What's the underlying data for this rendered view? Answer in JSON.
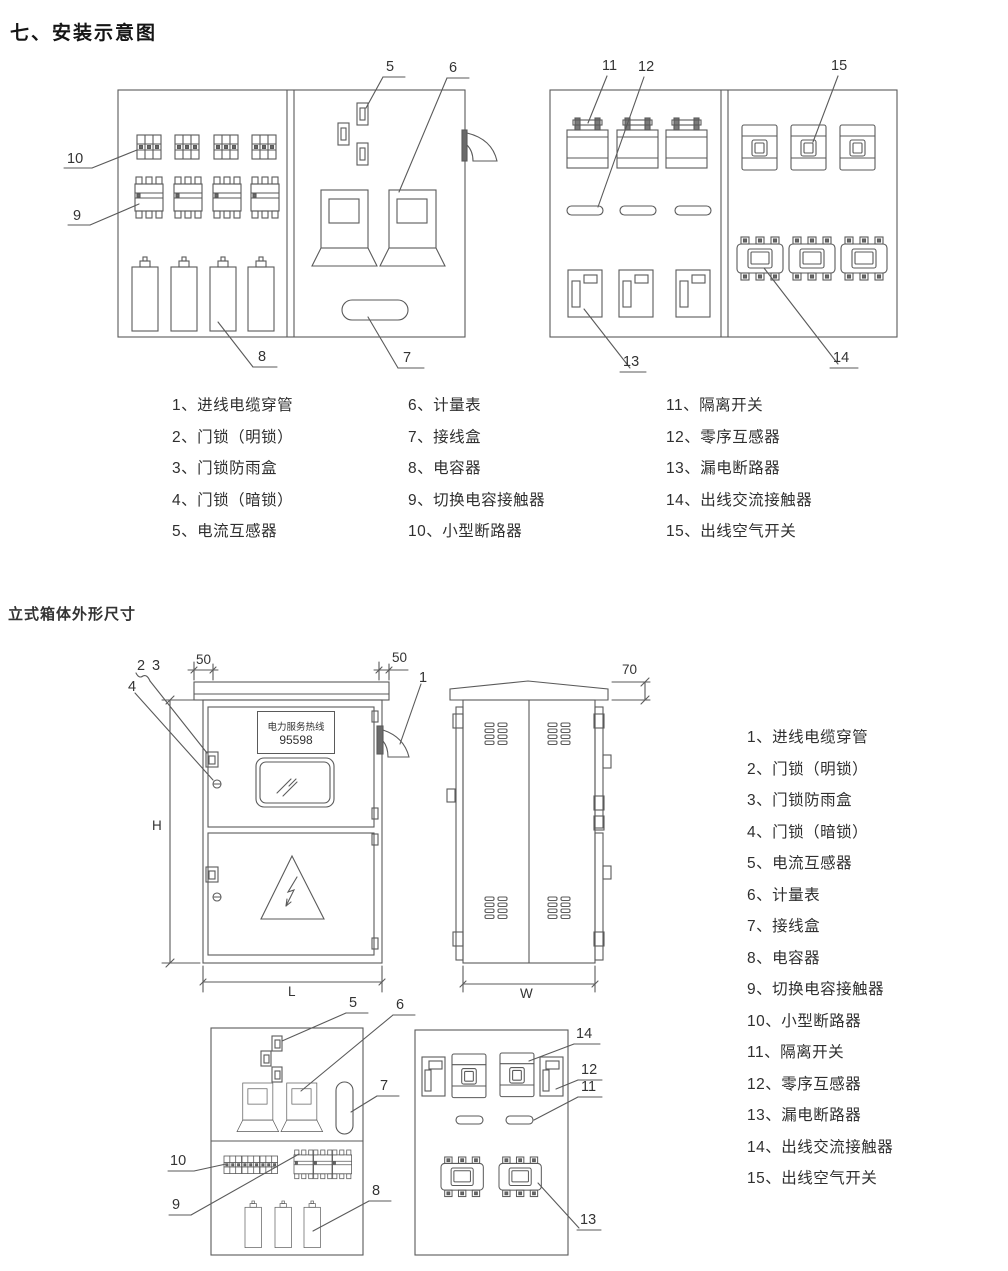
{
  "page": {
    "title": "七、安装示意图",
    "section2_title": "立式箱体外形尺寸"
  },
  "legend": {
    "items": [
      "1、进线电缆穿管",
      "2、门锁（明锁）",
      "3、门锁防雨盒",
      "4、门锁（暗锁）",
      "5、电流互感器",
      "6、计量表",
      "7、接线盒",
      "8、电容器",
      "9、切换电容接触器",
      "10、小型断路器",
      "11、隔离开关",
      "12、零序互感器",
      "13、漏电断路器",
      "14、出线交流接触器",
      "15、出线空气开关"
    ]
  },
  "callouts": {
    "c1": "1",
    "c2": "2",
    "c3": "3",
    "c4": "4",
    "c5": "5",
    "c6": "6",
    "c7": "7",
    "c8": "8",
    "c9": "9",
    "c10": "10",
    "c11": "11",
    "c12": "12",
    "c13": "13",
    "c14": "14",
    "c15": "15"
  },
  "dimensions": {
    "overhang_left": "50",
    "overhang_right": "50",
    "roof_height": "70",
    "height": "H",
    "length": "L",
    "width": "W"
  },
  "door_plate": {
    "line1": "电力服务热线",
    "line2": "95598"
  },
  "colors": {
    "line": "#5a5a5a",
    "dark_fill": "#6a6a6a",
    "text": "#2e2e2e"
  }
}
